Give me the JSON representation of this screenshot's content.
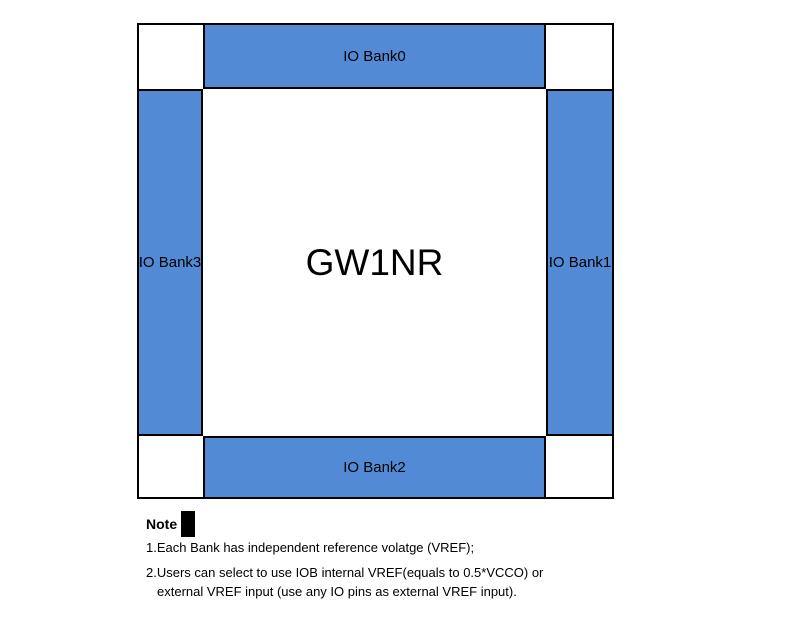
{
  "diagram": {
    "chip_label": "GW1NR",
    "banks": {
      "top": {
        "label": "IO Bank0"
      },
      "right": {
        "label": "IO Bank1"
      },
      "bottom": {
        "label": "IO Bank2"
      },
      "left": {
        "label": "IO Bank3"
      }
    },
    "colors": {
      "bank_fill": "#528AD5",
      "border": "#000000",
      "background": "#ffffff"
    }
  },
  "notes": {
    "heading": "Note",
    "note1": "1.Each Bank has independent reference volatge (VREF);",
    "note2_line1": "2.Users can select to use IOB internal VREF(equals to 0.5*VCCO) or",
    "note2_line2": "external VREF input (use any IO pins as external VREF input)."
  }
}
